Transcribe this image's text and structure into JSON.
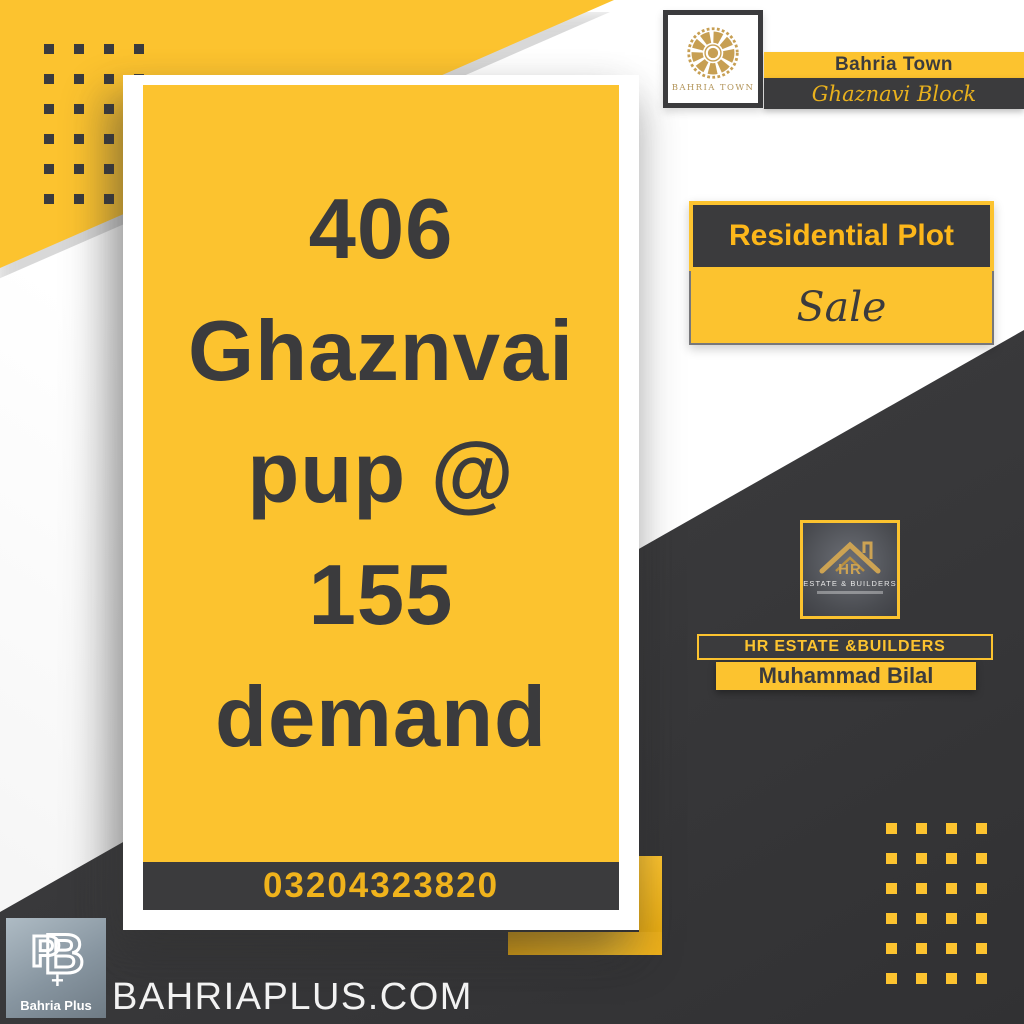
{
  "colors": {
    "yellow": "#FCC32F",
    "charcoal": "#3B3B3D",
    "gold_text": "#F0B31C",
    "emblem_gold": "#C79F53",
    "white": "#FFFFFF"
  },
  "header": {
    "logo_caption": "BAHRIA TOWN",
    "brand_bar": "Bahria Town",
    "block_bar": "Ghaznavi Block"
  },
  "listing": {
    "category": "Residential Plot",
    "status": "Sale"
  },
  "property_card": {
    "headline_lines": [
      "406",
      "Ghaznvai",
      "pup @",
      "155",
      "demand"
    ],
    "phone": "03204323820"
  },
  "agent": {
    "logo_monogram": "HR",
    "logo_caption": "ESTATE & BUILDERS",
    "company": "HR ESTATE &BUILDERS",
    "name": "Muhammad Bilal"
  },
  "footer": {
    "monogram_p": "P",
    "monogram_b": "B",
    "monogram_plus": "+",
    "logo_label": "Bahria Plus",
    "website": "BAHRIAPLUS.COM"
  }
}
